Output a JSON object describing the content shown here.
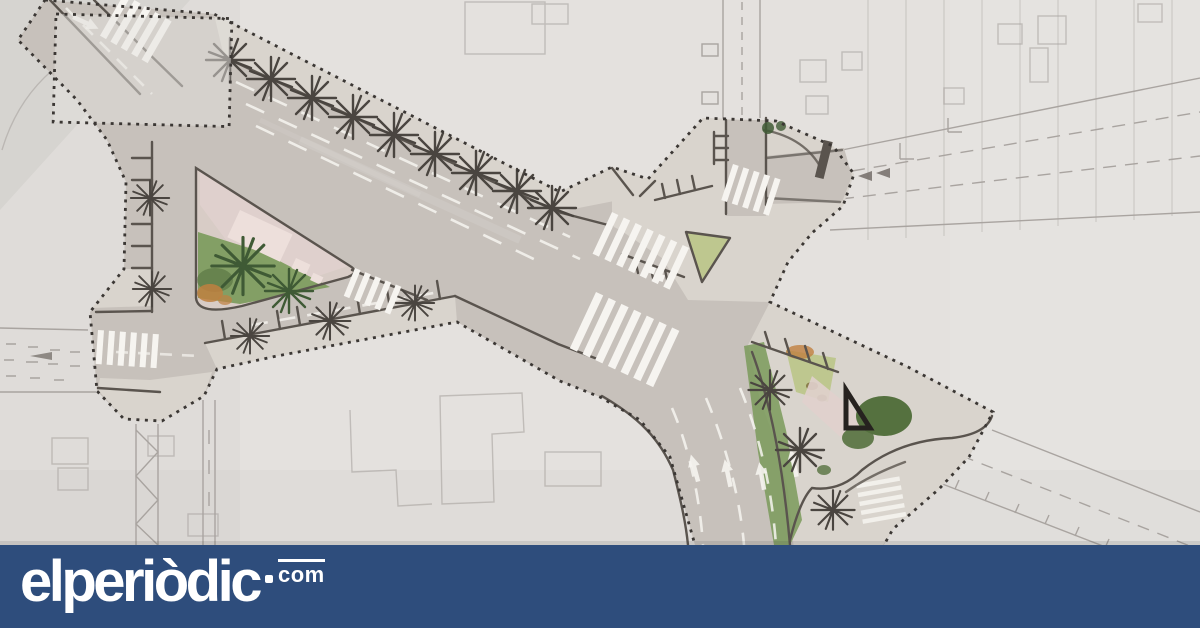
{
  "branding": {
    "logo_text": "elperiòdic",
    "logo_tld": "com"
  },
  "colors": {
    "paper": "#e4e1de",
    "paperLight": "#edebe8",
    "road": "#c7c1bb",
    "sidewalk": "#d9d4cd",
    "curb": "#5a544e",
    "tree": "#4a4540",
    "treeGreen": "#3f5a35",
    "marking": "#f6f4f0",
    "boundary": "#3b3734",
    "faint": "#a9a4a0",
    "faintDark": "#6b6560",
    "pink": "#e0d0cd",
    "pinkLight": "#eddfdb",
    "greenDark": "#55713f",
    "greenMid": "#7a9a5a",
    "greenLight": "#bec78f",
    "orange": "#c08040",
    "stairsDark": "#26221f",
    "barBlue": "#2e4d7c",
    "logoWhite": "#ffffff"
  },
  "plan": {
    "features": [
      "project-boundary-dotted",
      "diagonal-avenue-with-palm-row",
      "pedestrian-zebra-crossings",
      "landscaped-traffic-islands",
      "perpendicular-parking-bays",
      "white-lane-arrows",
      "existing-streets-pencil-sketch"
    ]
  }
}
